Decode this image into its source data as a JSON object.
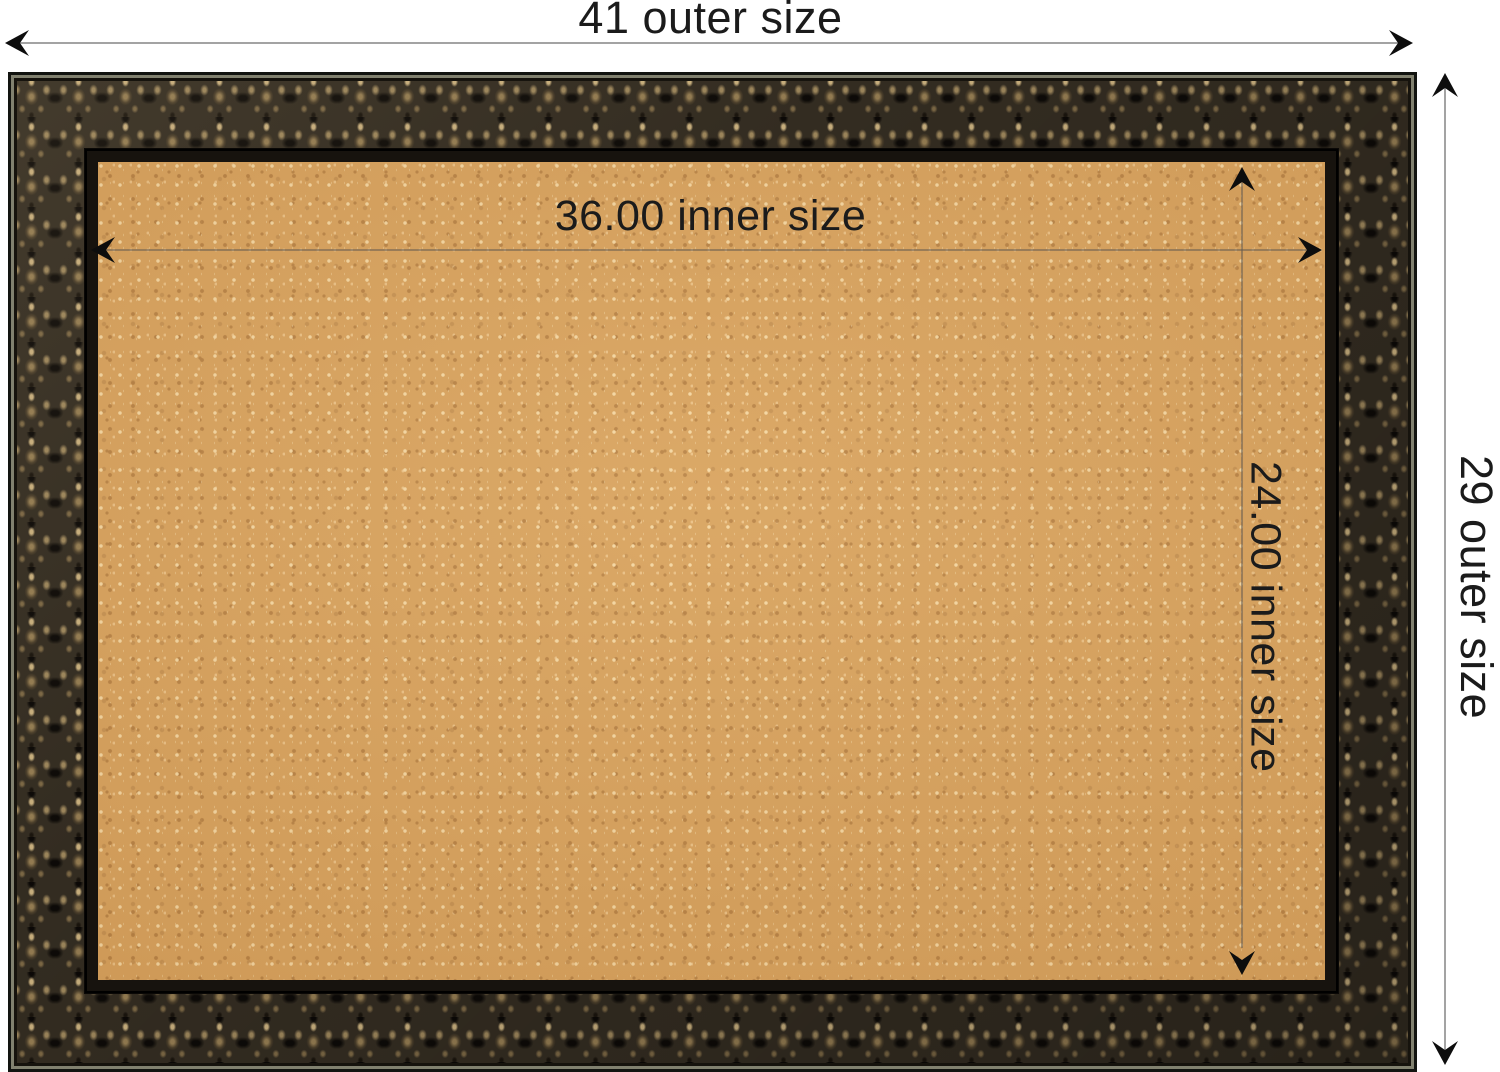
{
  "image_type": "framed cork bulletin board dimension diagram",
  "board": {
    "frame": {
      "style": "ornate embossed scrollwork",
      "base_color": "#332c21",
      "highlight_color": "#c6ad7c",
      "edge_line_color": "#81816f",
      "inner_lip_color": "#17130e"
    },
    "cork": {
      "base_color": "#d7a15c",
      "fleck_light_color": "#f6daa6",
      "fleck_dark_color": "#b07a3e"
    }
  },
  "annotations": {
    "text_color": "#1b1b1b",
    "outer_line_color": "#a3a3a3",
    "inner_line_color": "#685d50",
    "arrow_color": "#0d0d0d",
    "outer_width": {
      "label": "41 outer size",
      "value": "41"
    },
    "outer_height": {
      "label": "29 outer size",
      "value": "29"
    },
    "inner_width": {
      "label": "36.00 inner size",
      "value": "36.00"
    },
    "inner_height": {
      "label": "24.00 inner size",
      "value": "24.00"
    }
  }
}
